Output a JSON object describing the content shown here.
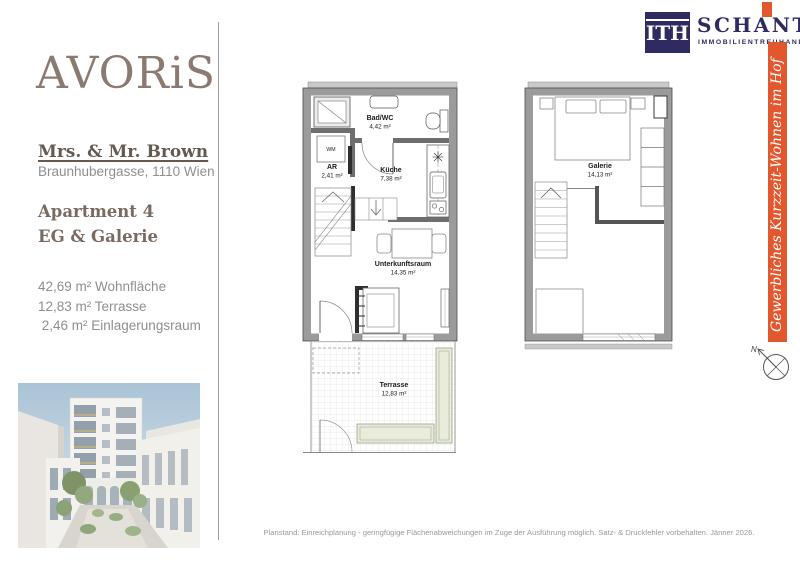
{
  "branding": {
    "avoris_logo": "AVORiS",
    "schantl": {
      "icon_text": "ITH",
      "name": "SCHANTL",
      "subtitle": "IMMOBILIENTREUHAND"
    }
  },
  "sidebar": {
    "client_name": "Mrs. & Mr. Brown",
    "address": "Braunhubergasse, 1110 Wien",
    "apartment": "Apartment 4",
    "level": "EG & Galerie",
    "areas": "42,69 m² Wohnfläche\n12,83 m² Terrasse\n 2,46 m² Einlagerungsraum"
  },
  "banner": {
    "text": "Gewerbliches Kurzzeit-Wohnen im Hof",
    "color": "#e2572e"
  },
  "floorplan_eg": {
    "rooms": [
      {
        "name": "Bad/WC",
        "area": "4,42 m²"
      },
      {
        "name": "AR",
        "area": "2,41 m²"
      },
      {
        "name": "Küche",
        "area": "7,38 m²"
      },
      {
        "name": "Unterkunftsraum",
        "area": "14,35 m²"
      },
      {
        "name": "Terrasse",
        "area": "12,83 m²"
      }
    ],
    "appliance_label": "WM"
  },
  "floorplan_galerie": {
    "rooms": [
      {
        "name": "Galerie",
        "area": "14,13 m²"
      }
    ]
  },
  "compass": {
    "label": "N"
  },
  "footer": {
    "disclaimer": "Planstand: Einreichplanung - geringfügige Flächenabweichungen im Zuge der Ausführung möglich. Satz- & Druckfehler vorbehalten. Jänner 2026."
  }
}
